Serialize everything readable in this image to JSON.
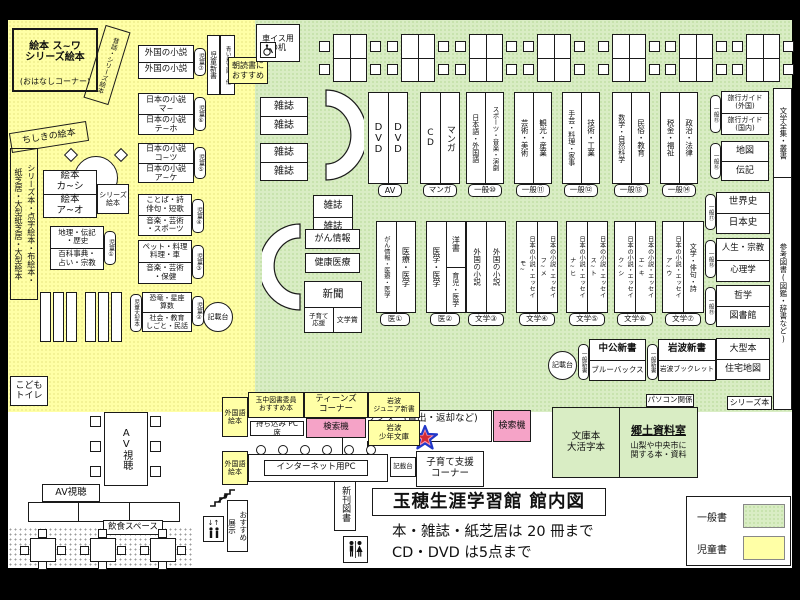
{
  "colors": {
    "area_general_green": "#d9edc4",
    "area_children_yellow": "#ffffa6",
    "search_machine_pink": "#f5a3c7"
  },
  "title_block": {
    "main": "玉穂生涯学習館 館内図",
    "rule1": "本・雑誌・紙芝居は 20 冊まで",
    "rule2": "CD・DVD は5点まで"
  },
  "legend": {
    "general": "一般書",
    "children": "児童書"
  },
  "children": {
    "ohanashi_main": "絵本 ス~ワ\nシリーズ絵本",
    "ohanashi_sub": "(おはなしコーナー)",
    "mukashi": "昔話・シリーズ絵本",
    "chishiki": "ちしきの絵本",
    "sideshelf": "シリーズ本・点字絵本・布絵本・\n紙芝居・大型紙芝居・大型絵本",
    "toilet": "こども\nトイレ",
    "shinsho": "児童新書",
    "aoitori": "青い鳥文庫・他",
    "asadoku": "朝読書に\nおすすめ",
    "kisaidai": "記載台",
    "ehon_top": "絵本\nカ~シ",
    "ehon_bottom": "絵本\nア~オ",
    "ehon_side": "シリーズ\n絵本",
    "boxes": [
      {
        "tab": "児童⑦",
        "top": "外国の小説",
        "bottom": "外国の小説"
      },
      {
        "tab": "児童⑥",
        "top": "日本の小説\nマ~",
        "bottom": "日本の小説\nテ~ホ"
      },
      {
        "tab": "児童⑤",
        "top": "日本の小説\nコ~ツ",
        "bottom": "日本の小説\nア~ケ"
      },
      {
        "tab": "児童④",
        "top": "ことば・詩\n俳句・短歌",
        "bottom": "音楽・芸術\n・スポーツ"
      },
      {
        "tab": "児童③",
        "top": "ペット・料理\n料理・車",
        "bottom": "音楽・芸術\n・保健"
      },
      {
        "tab": "児童①",
        "top": "地理・伝記\n・歴史",
        "bottom": "百科事典・\n占い・宗教"
      },
      {
        "tab": "児童②",
        "left_tab": "児童大型本",
        "top": "恐竜・星座\n算数",
        "bottom": "社会・教育\nしごと・民話"
      }
    ]
  },
  "top_area": {
    "wheel_desk": "車イス用\nの机",
    "magazine": "雑誌"
  },
  "av": {
    "dvd": "DVD",
    "av_label": "AV",
    "cd": "CD",
    "manga": "マンガ",
    "manga_label": "マンガ"
  },
  "gen_cols": [
    {
      "left": "日本語・外国語",
      "right": "スポーツ・音楽・演劇",
      "label": "一般⑩"
    },
    {
      "left": "芸術・美術",
      "right": "観光・産業",
      "label": "一般⑪"
    },
    {
      "left": "手芸・料理・家事",
      "right": "技術・工業",
      "label": "一般⑫"
    },
    {
      "left": "数学・自然科学",
      "right": "民俗・教育",
      "label": "一般⑬"
    },
    {
      "left": "税金・福祉",
      "right": "政治・法律",
      "label": "一般⑭"
    }
  ],
  "right_stacks": [
    {
      "tab": "一般⑮",
      "top": "旅行ガイド\n(外国)",
      "bottom": "旅行ガイド\n(国内)"
    },
    {
      "tab": "一般⑯",
      "top": "地図",
      "bottom": "伝記"
    },
    {
      "tab": "一般⑰",
      "top": "世界史",
      "bottom": "日本史"
    },
    {
      "tab": "一般⑱",
      "top": "人生・宗教",
      "bottom": "心理学"
    },
    {
      "tab": "一般⑲",
      "top": "哲学",
      "bottom": "図書館"
    },
    {
      "tab": "",
      "top": "大型本",
      "bottom": "住宅地図"
    }
  ],
  "right_strip": {
    "top": "文学全集・叢書",
    "bottom": "参考図書(図鑑・辞書など)"
  },
  "mid": {
    "gan": "がん情報",
    "kenko": "健康医療",
    "shimbun": "新聞",
    "kosodate": "子育て\n応援",
    "bungakusho": "文学賞"
  },
  "med_cols": [
    {
      "label": "医①",
      "left": "がん情報・医療・医学",
      "right": "医療・医学"
    },
    {
      "label": "医②",
      "left": "医学・医学",
      "right_top": "洋書",
      "right_bottom": "育児・医学"
    }
  ],
  "lit_cols": [
    {
      "label": "文学③",
      "left": "外国の小説",
      "right": "外国の小説"
    },
    {
      "label": "文学④",
      "left": "日本の小説・エッセイ\nモ~",
      "right": "日本の小説・エッセイ\nフ~メ"
    },
    {
      "label": "文学⑤",
      "left": "日本の小説・エッセイ\nナ~ヒ",
      "right": "日本の小説・エッセイ\nス~ト"
    },
    {
      "label": "文学⑥",
      "left": "日本の小説・エッセイ\nク~シ",
      "right": "日本の小説・エッセイ\nエ~キ"
    },
    {
      "label": "文学⑦",
      "left": "日本の小説・エッセイ\nア~ウ",
      "right": "文学・俳句・詩"
    }
  ],
  "shinsho_row": {
    "kisaidai": "記載台",
    "tab": "一般新書",
    "chuko_top": "中公新書",
    "chuko_bottom": "ブルーバックス",
    "iwanami_top": "岩波新書",
    "iwanami_bottom": "岩波ブックレット",
    "pc_label": "パソコン関係",
    "series_label": "シリーズ本"
  },
  "counter": {
    "label": "カウンター(貸出・返却など)",
    "search": "検索機",
    "bunko": "文庫本\n大活字本",
    "kyodo_title": "郷土資料室",
    "kyodo_desc": "山梨や中央市に\n関する本・資料",
    "shinkan": "新刊図書"
  },
  "bottom": {
    "av_table": "AV視聴",
    "av_booth": "AV視聴",
    "gaikokugo": "外国語\n絵本",
    "tamachu": "玉中図書委員\nおすすめ本",
    "teens": "ティーンズ\nコーナー",
    "iwanami_jr": "岩波\nジュニア新書",
    "mochikomi": "持ち込み PC 席",
    "search2": "検索機",
    "iwanami_shonen": "岩波\n少年文庫",
    "gaikokugo2": "外国語\n絵本",
    "internet": "インターネット用PC",
    "kisaidai2": "記載台",
    "kosodate_shien": "子育て支援\nコーナー",
    "osusume": "おすすめ\n展示",
    "inshoku": "飲食スペース"
  }
}
